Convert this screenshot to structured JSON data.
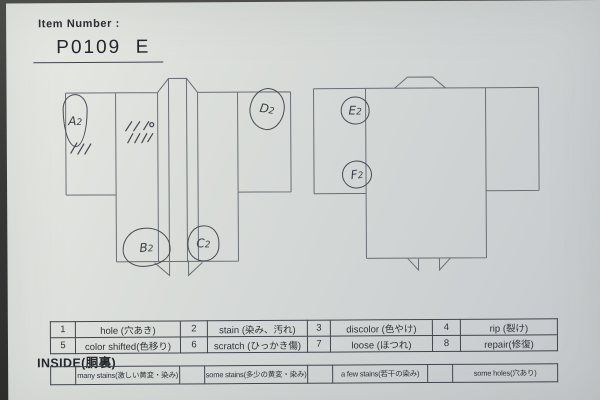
{
  "header": {
    "item_number_label": "Item Number :",
    "item_number_value": "P0109  E"
  },
  "annotations": [
    {
      "letter": "A",
      "sub": "2"
    },
    {
      "letter": "B",
      "sub": "2"
    },
    {
      "letter": "C",
      "sub": "2"
    },
    {
      "letter": "D",
      "sub": "2"
    },
    {
      "letter": "E",
      "sub": "2"
    },
    {
      "letter": "F",
      "sub": "2"
    }
  ],
  "defect_table": {
    "rows": [
      {
        "cells": [
          {
            "num": "1",
            "label": "hole (穴あき)"
          },
          {
            "num": "2",
            "label": "stain (染み、汚れ)"
          },
          {
            "num": "3",
            "label": "discolor (色やけ)"
          },
          {
            "num": "4",
            "label": "rip (裂け)"
          }
        ]
      },
      {
        "cells": [
          {
            "num": "5",
            "label": "color shifted(色移り)"
          },
          {
            "num": "6",
            "label": "scratch (ひっかき傷)"
          },
          {
            "num": "7",
            "label": "loose (ほつれ)"
          },
          {
            "num": "8",
            "label": "repair(修復)"
          }
        ]
      }
    ]
  },
  "inside": {
    "title": "INSIDE(胴裏)",
    "options": [
      {
        "label": "many stains(激しい黄変・染み)"
      },
      {
        "label": "some stains(多少の黄変・染み)"
      },
      {
        "label": "a few stains(若干の染み)"
      },
      {
        "label": "some holes(穴あり)"
      }
    ]
  },
  "colors": {
    "paper": "#d4d7d4",
    "printed_ink": "#30353b",
    "handwritten_ink": "#3c4048",
    "photo_background": "#3a3a38"
  }
}
